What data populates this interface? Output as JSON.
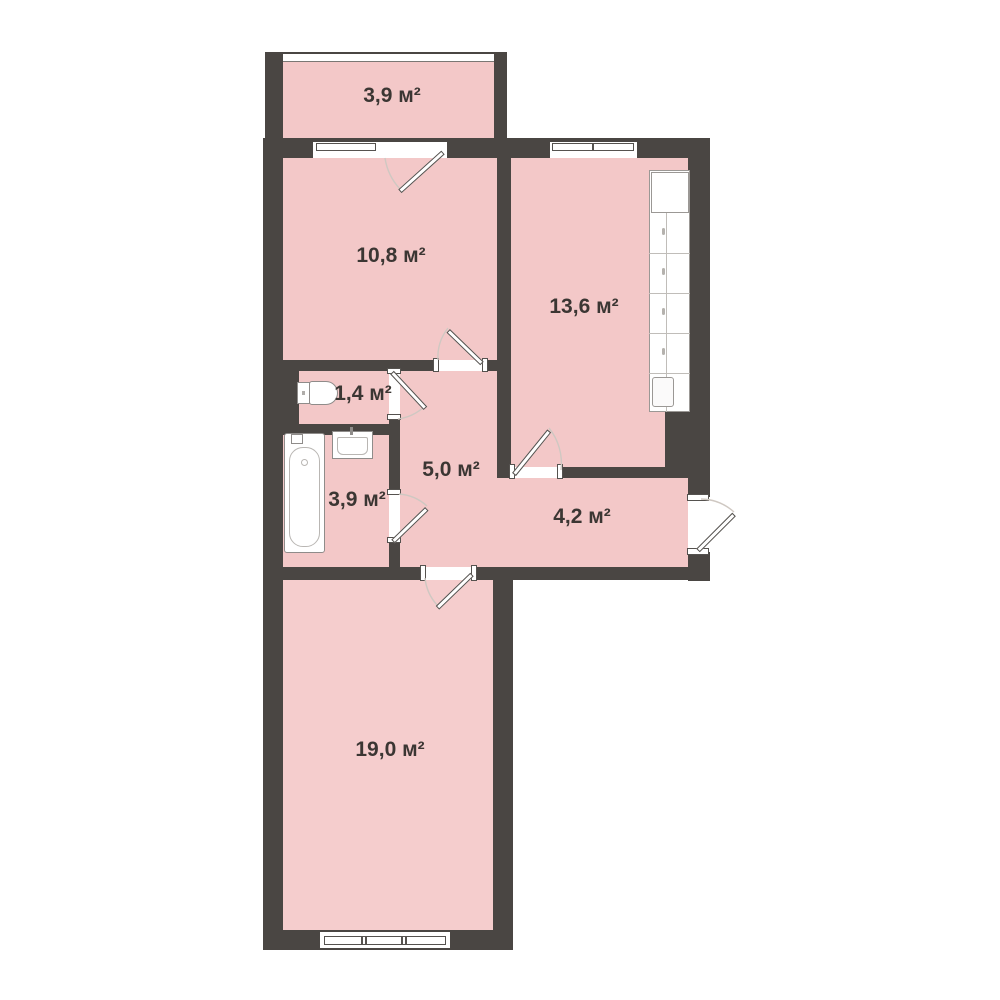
{
  "colors": {
    "background": "#ffffff",
    "wall": "#4a4643",
    "room_fill": "#f3c8c8",
    "room_fill_light": "#f5cdcd",
    "label_text": "#3b3633",
    "door_leaf_outline": "#53504d",
    "swing_arc": "#cfc8c2",
    "fixture_outline": "#8f8c8a"
  },
  "rooms": {
    "balcony": {
      "label": "3,9 м²",
      "area_m2": 3.9
    },
    "bedroom": {
      "label": "10,8 м²",
      "area_m2": 10.8
    },
    "kitchen": {
      "label": "13,6 м²",
      "area_m2": 13.6
    },
    "wc": {
      "label": "1,4 м²",
      "area_m2": 1.4
    },
    "hallway": {
      "label": "5,0 м²",
      "area_m2": 5.0
    },
    "bathroom": {
      "label": "3,9 м²",
      "area_m2": 3.9
    },
    "corridor": {
      "label": "4,2 м²",
      "area_m2": 4.2
    },
    "living_room": {
      "label": "19,0 м²",
      "area_m2": 19.0
    }
  },
  "fixtures": [
    "bathtub",
    "sink",
    "toilet",
    "kitchen-cabinets",
    "windows",
    "doors"
  ]
}
